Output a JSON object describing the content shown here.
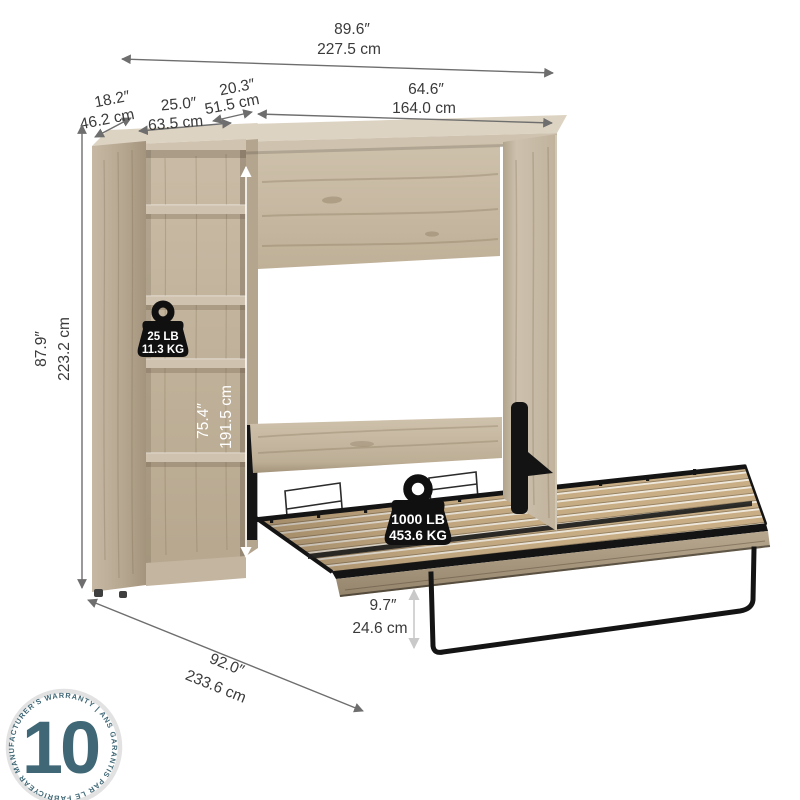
{
  "dims": {
    "overall_width": {
      "in": "89.6″",
      "cm": "227.5 cm"
    },
    "cabinet_top_depth": {
      "in": "20.3″",
      "cm": "51.5 cm"
    },
    "cabinet_width": {
      "in": "64.6″",
      "cm": "164.0 cm"
    },
    "bookcase_depth": {
      "in": "18.2″",
      "cm": "46.2 cm"
    },
    "bookcase_width": {
      "in": "25.0″",
      "cm": "63.5 cm"
    },
    "overall_height": {
      "in": "87.9″",
      "cm": "223.2 cm"
    },
    "interior_clearance_height": {
      "in": "75.4″",
      "cm": "191.5 cm"
    },
    "bed_floor_clearance": {
      "in": "9.7″",
      "cm": "24.6 cm"
    },
    "wall_to_foot_depth": {
      "in": "92.0″",
      "cm": "233.6 cm"
    }
  },
  "capacity": {
    "shelf": {
      "lb": "25 LB",
      "kg": "11.3 KG",
      "icon": "weight-icon"
    },
    "bed": {
      "lb": "1000 LB",
      "kg": "453.6 KG",
      "icon": "weight-icon"
    }
  },
  "warranty": {
    "years": "10",
    "ring_text": "YEAR MANUFACTURER'S WARRANTY  |  ANS GARANTIS PAR LE FABRICANT  |",
    "icon": "warranty-seal-icon"
  },
  "colors": {
    "dimension_line": "#6e6e6e",
    "dimension_text": "#3a3a3a",
    "capacity_badge": "#111111",
    "warranty_accent": "#3f6775",
    "wood_light": "#d8cdbb",
    "wood_mid": "#c2b39d",
    "wood_dark": "#9c8c75",
    "metal_frame": "#141414",
    "slat_wood": "#c9ae85"
  }
}
